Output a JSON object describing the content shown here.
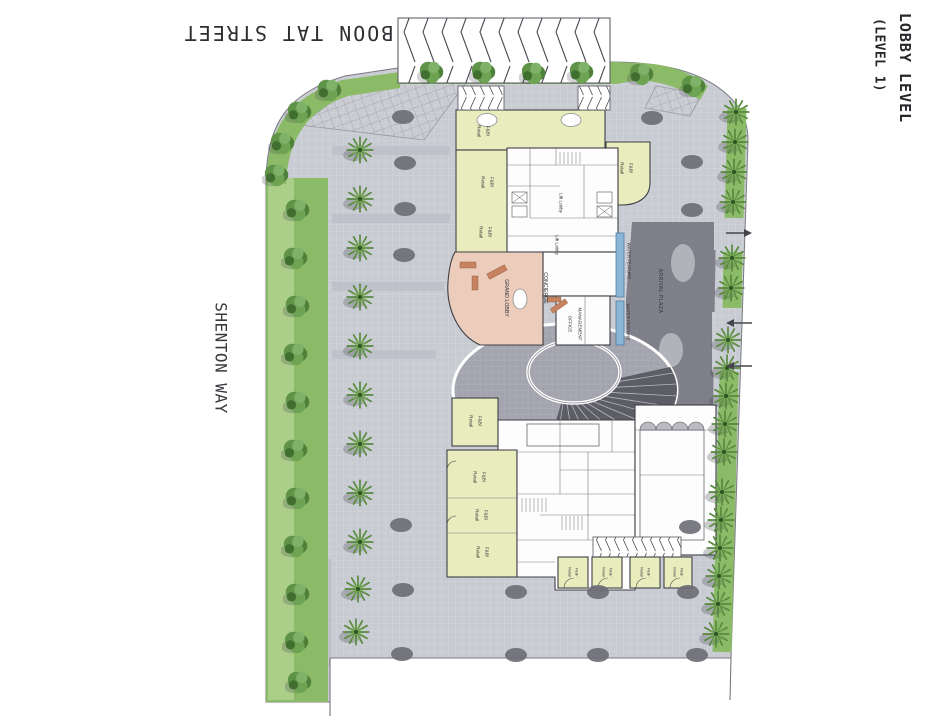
{
  "sheet_title": {
    "line1": "LOBBY LEVEL",
    "line2": "(LEVEL 1)"
  },
  "streets": {
    "top": "BOON TAT STREET",
    "left": "SHENTON WAY"
  },
  "rooms": {
    "fb_line1": "F&B/",
    "fb_line2": "Retail",
    "lift_lobby": "Lift Lobby",
    "grand_lobby": "GRAND LOBBY",
    "concierge": "CONCIERGE",
    "management_line1": "MANAGEMENT",
    "management_line2": "OFFICE",
    "water_feature": "WATER FEATURE",
    "arrival_plaza": "ARRIVAL PLAZA"
  },
  "colors": {
    "paving": "#c9cbd3",
    "ring_paving": "#a4a4ae",
    "fan_dark": "#5d5d66",
    "arrival": "#7f7f89",
    "green": "#8cbb68",
    "green_light": "#aed08d",
    "retail": "#e9edbd",
    "grand_lobby": "#eccdbb",
    "furniture": "#c7825f",
    "water": "#8ab6d6",
    "wall": "#3f3f46",
    "tree_pit": "#6b6b74",
    "text": "#33333a"
  }
}
